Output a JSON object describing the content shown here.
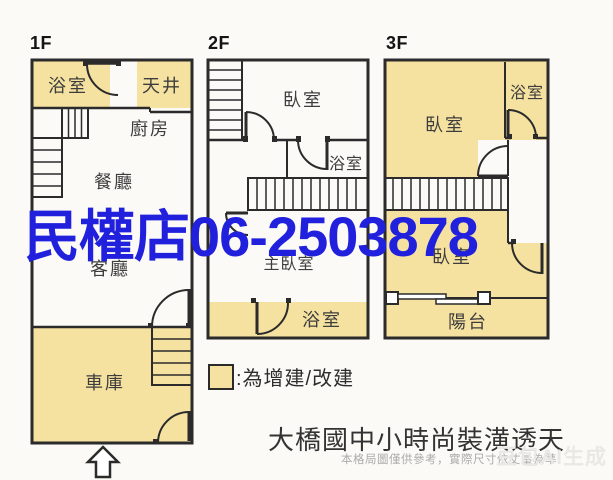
{
  "floors": [
    {
      "label": "1F",
      "rooms": [
        "浴室",
        "天井",
        "廚房",
        "餐廳",
        "客廳",
        "車庫"
      ]
    },
    {
      "label": "2F",
      "rooms": [
        "臥室",
        "浴室",
        "主臥室",
        "浴室"
      ]
    },
    {
      "label": "3F",
      "rooms": [
        "臥室",
        "浴室",
        "臥室",
        "陽台"
      ]
    }
  ],
  "legend": {
    "text": ":為增建/改建",
    "swatch_color": "#f6e2a0"
  },
  "watermark": {
    "text": "民權店06-2503878",
    "color": "#2121dd"
  },
  "footer": {
    "title": "大橋國中小時尚裝潢透天",
    "disclaimer": "本格局圖僅供參考，實際尺寸依丈量為準",
    "ai_watermark": "豆包AI生成"
  },
  "colors": {
    "addition_fill": "#f6e2a0",
    "wall": "#2b2b2b",
    "background": "#fbfaf7"
  }
}
